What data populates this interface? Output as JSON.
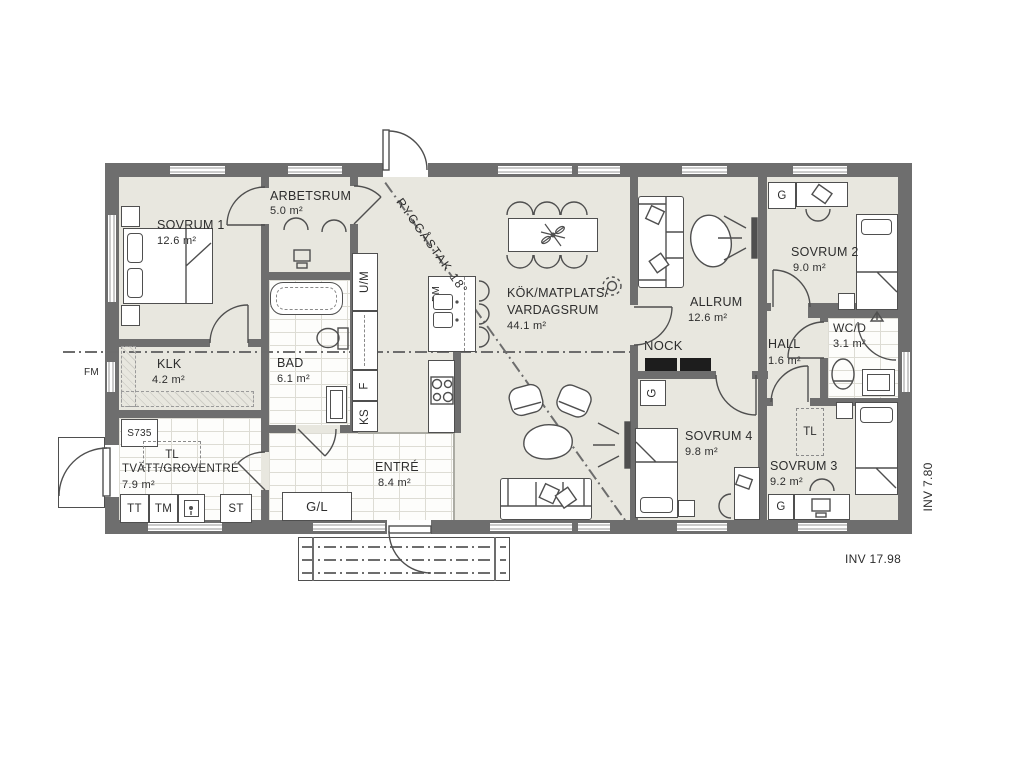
{
  "rooms": {
    "sovrum1": {
      "name": "SOVRUM 1",
      "area": "12.6 m²"
    },
    "arbetsrum": {
      "name": "ARBETSRUM",
      "area": "5.0 m²"
    },
    "klk": {
      "name": "KLK",
      "area": "4.2 m²"
    },
    "bad": {
      "name": "BAD",
      "area": "6.1 m²"
    },
    "tvatt": {
      "name": "TVÄTT/GROVENTRÉ",
      "area": "7.9 m²"
    },
    "entre": {
      "name": "ENTRÉ",
      "area": "8.4 m²"
    },
    "kok": {
      "line1": "KÖK/MATPLATS/",
      "line2": "VARDAGSRUM",
      "area": "44.1 m²"
    },
    "allrum": {
      "name": "ALLRUM",
      "area": "12.6 m²"
    },
    "sovrum2": {
      "name": "SOVRUM 2",
      "area": "9.0 m²"
    },
    "hall": {
      "name": "HALL",
      "area": "1.6 m²"
    },
    "wcd": {
      "name": "WC/D",
      "area": "3.1 m²"
    },
    "sovrum4": {
      "name": "SOVRUM 4",
      "area": "9.8 m²"
    },
    "sovrum3": {
      "name": "SOVRUM 3",
      "area": "9.2 m²"
    }
  },
  "fixtures": {
    "um": "U/M",
    "f": "F",
    "ks": "KS",
    "dm": "DM",
    "tt": "TT",
    "tm": "TM",
    "st": "ST",
    "gl": "G/L",
    "g": "G",
    "tl": "TL",
    "s735": "S735",
    "fm": "FM"
  },
  "annotations": {
    "ridge": "RYGGÅSTAK 18°",
    "nock": "NOCK",
    "inv_width": "INV 7.80",
    "inv_length": "INV 17.98"
  },
  "colors": {
    "wall": "#6e6e6e",
    "floor": "#e8e7df",
    "line": "#4f4f4f"
  }
}
